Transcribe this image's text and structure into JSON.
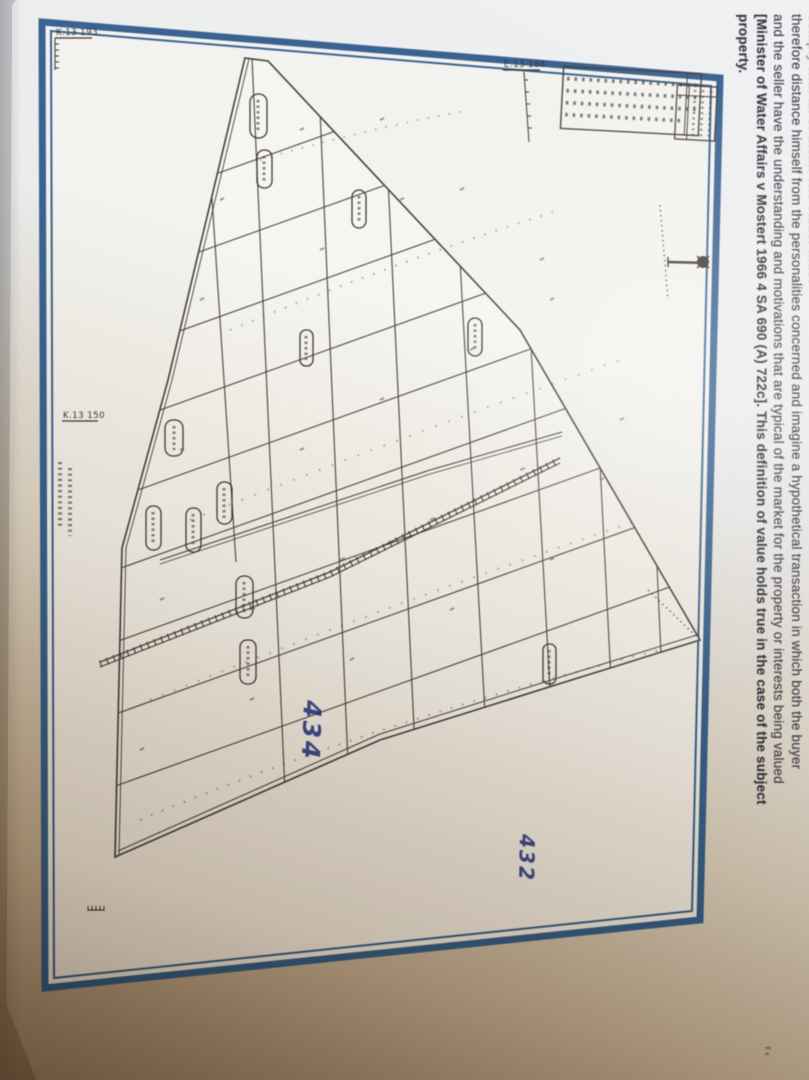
{
  "photo": {
    "description": "Photographed report page with cadastral survey diagram",
    "background_top": "#c9cdd4",
    "background_bottom": "#967c59",
    "page_color": "#eceef0"
  },
  "report_text": {
    "lines": [
      {
        "text": "comply with all of them. The Valuer must"
      },
      {
        "text": "therefore distance himself from the personalities concerned and imagine a hypothetical transaction in which both the buyer"
      },
      {
        "text": "and the seller have the understanding and motivations that are typical of the market for the property or interests being valued"
      },
      {
        "text": "[Minister of Water Affairs v Mostert 1966 4 SA 690 (A) 722c]. This definition of value holds true in the case of the subject"
      },
      {
        "text": "property."
      }
    ]
  },
  "diagram": {
    "frame_color": "#3a6391",
    "ink_color": "#4a443d",
    "handwriting_color": "#2c3a8c",
    "reference_labels": [
      {
        "label": "K.13 193"
      },
      {
        "label": "E.13 188"
      },
      {
        "label": "K.13 150"
      }
    ],
    "handwritten_numbers": [
      {
        "text": "434"
      },
      {
        "text": "432"
      }
    ]
  }
}
